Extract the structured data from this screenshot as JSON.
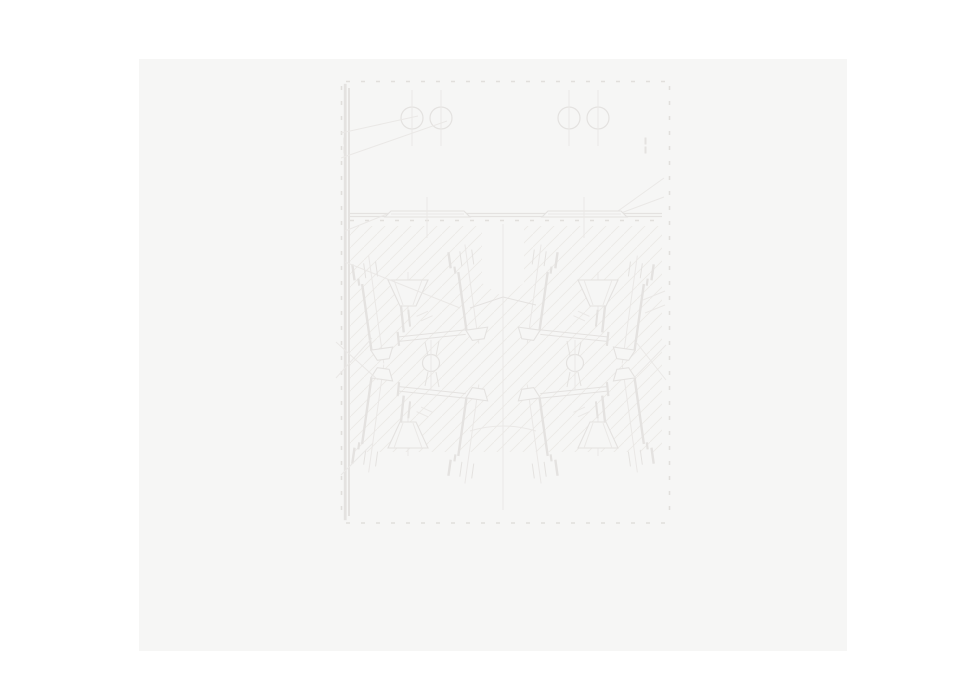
{
  "palette": {
    "page_background": "#ffffff",
    "canvas_background": "#f6f6f5",
    "line": "#e4e2e0",
    "faint": "#eae8e6",
    "tick": "#e1dfdc",
    "hatch": "#eceae8",
    "bg": "#f6f6f5"
  },
  "canvas": {
    "x": 139,
    "y": 59,
    "width": 708,
    "height": 592
  },
  "drawing": {
    "type": "technical-section-drawing",
    "viewbox": "0 0 961 694",
    "hatch": {
      "size": 13
    },
    "frame": {
      "outer": [
        344.5,
        84.5,
        322,
        435
      ],
      "inner": [
        348.5,
        88.5,
        314,
        427
      ]
    },
    "under_shapes": [
      {
        "t": "rect",
        "x": 139,
        "y": 59,
        "w": 708,
        "h": 592,
        "f": "canvas_background",
        "s": "none",
        "name": "canvas-panel"
      },
      {
        "t": "rect",
        "x": 349,
        "y": 226,
        "w": 313,
        "h": 226,
        "f": "url(#hatch)",
        "s": "none",
        "name": "section-hatch-region"
      },
      {
        "t": "poly",
        "pts": "482,222 524,222 524,283 503,297 482,283",
        "f": "bg",
        "s": "none",
        "name": "center-clear-notch"
      }
    ],
    "assembly": {
      "groups": [
        {
          "name": "bolt-assembly-upper-left",
          "tr": ""
        },
        {
          "name": "bolt-assembly-upper-right",
          "tr": "translate(1006 0) scale(-1 1)"
        },
        {
          "name": "bolt-assembly-lower-left",
          "tr": "translate(0 728) scale(1 -1)"
        },
        {
          "name": "bolt-assembly-lower-right",
          "tr": "translate(1006 728) scale(-1 -1)"
        }
      ],
      "shapes": [
        {
          "t": "g",
          "tr": "rotate(-8 376 308)",
          "name": "outer-stud-bolt",
          "items": [
            {
              "t": "line",
              "x1": 376,
              "y1": 255,
              "x2": 376,
              "y2": 364,
              "s": "faint",
              "w": 1
            },
            {
              "t": "rect",
              "x": 358,
              "y": 262,
              "w": 1.2,
              "h": 15,
              "s": "line",
              "f": "bg"
            },
            {
              "t": "line",
              "x1": 370,
              "y1": 262,
              "x2": 370,
              "y2": 277,
              "s": "line",
              "w": 1
            },
            {
              "t": "line",
              "x1": 382,
              "y1": 262,
              "x2": 382,
              "y2": 277,
              "s": "line",
              "w": 1
            },
            {
              "t": "rect",
              "x": 362,
              "y": 277,
              "w": 1.1,
              "h": 6,
              "s": "line",
              "f": "bg"
            },
            {
              "t": "rect",
              "x": 365,
              "y": 283,
              "w": 1.2,
              "h": 66,
              "s": "line",
              "f": "bg"
            },
            {
              "t": "poly",
              "pts": "365,349 387,349 382,360 370,360",
              "s": "line",
              "f": "bg",
              "w": 1.1
            }
          ]
        },
        {
          "t": "g",
          "tr": "rotate(-8 472 295)",
          "name": "inner-stud-bolt",
          "items": [
            {
              "t": "line",
              "x1": 472,
              "y1": 244,
              "x2": 472,
              "y2": 344,
              "s": "faint",
              "w": 1
            },
            {
              "t": "rect",
              "x": 454,
              "y": 250,
              "w": 1.2,
              "h": 15,
              "s": "line",
              "f": "bg"
            },
            {
              "t": "line",
              "x1": 466,
              "y1": 250,
              "x2": 466,
              "y2": 265,
              "s": "line",
              "w": 1
            },
            {
              "t": "line",
              "x1": 478,
              "y1": 250,
              "x2": 478,
              "y2": 265,
              "s": "line",
              "w": 1
            },
            {
              "t": "rect",
              "x": 458,
              "y": 265,
              "w": 1.1,
              "h": 6,
              "s": "line",
              "f": "bg"
            },
            {
              "t": "rect",
              "x": 461,
              "y": 271,
              "w": 1.2,
              "h": 58,
              "s": "line",
              "f": "bg"
            },
            {
              "t": "poly",
              "pts": "461,329 483,329 478,340 466,340",
              "s": "line",
              "f": "bg",
              "w": 1.1
            }
          ]
        },
        {
          "t": "g",
          "tr": "",
          "name": "countersink-funnel",
          "items": [
            {
              "t": "line",
              "x1": 408,
              "y1": 272,
              "x2": 408,
              "y2": 314,
              "s": "faint",
              "w": 1
            },
            {
              "t": "poly",
              "pts": "388,280 428,280 416,306 400,306",
              "s": "line",
              "f": "bg",
              "w": 1.1
            },
            {
              "t": "line",
              "x1": 394,
              "y1": 280,
              "x2": 403,
              "y2": 305,
              "s": "faint",
              "w": 1
            },
            {
              "t": "line",
              "x1": 422,
              "y1": 280,
              "x2": 413,
              "y2": 305,
              "s": "faint",
              "w": 1
            }
          ]
        },
        {
          "t": "g",
          "tr": "rotate(-6 430 320)",
          "name": "gate-block",
          "items": [
            {
              "t": "rect",
              "x": 402,
              "y": 303,
              "w": 1.2,
              "h": 26,
              "s": "line",
              "f": "bg"
            },
            {
              "t": "rect",
              "x": 409,
              "y": 308,
              "w": 1,
              "h": 16,
              "s": "line",
              "f": "bg"
            },
            {
              "t": "line",
              "x1": 417,
              "y1": 315,
              "x2": 429,
              "y2": 311,
              "s": "faint",
              "w": 1
            },
            {
              "t": "line",
              "x1": 421,
              "y1": 320,
              "x2": 433,
              "y2": 316,
              "s": "faint",
              "w": 1
            },
            {
              "t": "rect",
              "x": 396,
              "y": 329,
              "w": 1.1,
              "h": 13,
              "s": "line",
              "f": "bg"
            },
            {
              "t": "line",
              "x1": 396,
              "y1": 333.5,
              "x2": 464,
              "y2": 333.5,
              "s": "line",
              "w": 1
            },
            {
              "t": "line",
              "x1": 396,
              "y1": 338,
              "x2": 464,
              "y2": 338,
              "s": "line",
              "w": 1
            }
          ]
        },
        {
          "t": "g",
          "tr": "",
          "name": "valve-stem-lines",
          "items": [
            {
              "t": "line",
              "x1": 425,
              "y1": 342,
              "x2": 428,
              "y2": 356,
              "s": "line",
              "w": 1
            },
            {
              "t": "line",
              "x1": 439,
              "y1": 341,
              "x2": 436,
              "y2": 356,
              "s": "line",
              "w": 1
            }
          ]
        }
      ]
    },
    "over_shapes": [
      {
        "t": "rect",
        "x": 344.5,
        "y": 84.5,
        "w": 1.4,
        "h": 435,
        "s": "line",
        "f": "none",
        "name": "frame-outer-border"
      },
      {
        "t": "rect",
        "x": 348.5,
        "y": 88.5,
        "w": 1,
        "h": 427,
        "s": "line",
        "f": "none",
        "name": "frame-inner-border"
      },
      {
        "t": "line",
        "x1": 346,
        "y1": 81.5,
        "x2": 666,
        "y2": 81.5,
        "s": "tick",
        "w": 1.6,
        "dash": "4 11",
        "name": "frame-ticks-top"
      },
      {
        "t": "line",
        "x1": 346,
        "y1": 523,
        "x2": 666,
        "y2": 523,
        "s": "tick",
        "w": 1.6,
        "dash": "4 11",
        "name": "frame-ticks-bottom"
      },
      {
        "t": "line",
        "x1": 341.5,
        "y1": 86,
        "x2": 341.5,
        "y2": 519,
        "s": "tick",
        "w": 1.6,
        "dash": "4 11",
        "name": "frame-ticks-left"
      },
      {
        "t": "line",
        "x1": 669.5,
        "y1": 86,
        "x2": 669.5,
        "y2": 519,
        "s": "tick",
        "w": 1.6,
        "dash": "4 11",
        "name": "frame-ticks-right"
      },
      {
        "t": "rect",
        "x": 344,
        "y": 138,
        "w": 1,
        "h": 6,
        "s": "line",
        "f": "bg",
        "name": "wall-tab-left-upper"
      },
      {
        "t": "rect",
        "x": 344,
        "y": 147,
        "w": 1,
        "h": 6,
        "s": "line",
        "f": "bg",
        "name": "wall-tab-left-lower"
      },
      {
        "t": "rect",
        "x": 645,
        "y": 138,
        "w": 1,
        "h": 6,
        "s": "line",
        "f": "bg",
        "name": "wall-tab-right-upper"
      },
      {
        "t": "rect",
        "x": 645,
        "y": 147,
        "w": 1,
        "h": 6,
        "s": "line",
        "f": "bg",
        "name": "wall-tab-right-lower"
      },
      {
        "t": "line",
        "x1": 348,
        "y1": 213.5,
        "x2": 662,
        "y2": 213.5,
        "s": "line",
        "w": 1.2,
        "name": "divider-plate-top"
      },
      {
        "t": "line",
        "x1": 348,
        "y1": 216.5,
        "x2": 662,
        "y2": 216.5,
        "s": "line",
        "w": 1.2,
        "name": "divider-plate-bottom"
      },
      {
        "t": "line",
        "x1": 350,
        "y1": 220.5,
        "x2": 662,
        "y2": 220.5,
        "s": "tick",
        "w": 1.4,
        "dash": "4 11",
        "name": "divider-ticks"
      },
      {
        "t": "circle",
        "cx": 412,
        "cy": 118,
        "r": 11,
        "s": "line",
        "f": "none",
        "w": 1.2,
        "name": "top-hole-1"
      },
      {
        "t": "circle",
        "cx": 441,
        "cy": 118,
        "r": 11,
        "s": "line",
        "f": "none",
        "w": 1.2,
        "name": "top-hole-2"
      },
      {
        "t": "circle",
        "cx": 569,
        "cy": 118,
        "r": 11,
        "s": "line",
        "f": "none",
        "w": 1.2,
        "name": "top-hole-3"
      },
      {
        "t": "circle",
        "cx": 598,
        "cy": 118,
        "r": 11,
        "s": "line",
        "f": "none",
        "w": 1.2,
        "name": "top-hole-4"
      },
      {
        "t": "line",
        "x1": 412,
        "y1": 90,
        "x2": 412,
        "y2": 146,
        "s": "faint",
        "w": 1,
        "name": "hole-centerline-1"
      },
      {
        "t": "line",
        "x1": 441,
        "y1": 90,
        "x2": 441,
        "y2": 146,
        "s": "faint",
        "w": 1,
        "name": "hole-centerline-2"
      },
      {
        "t": "line",
        "x1": 569,
        "y1": 90,
        "x2": 569,
        "y2": 146,
        "s": "faint",
        "w": 1,
        "name": "hole-centerline-3"
      },
      {
        "t": "line",
        "x1": 598,
        "y1": 90,
        "x2": 598,
        "y2": 146,
        "s": "faint",
        "w": 1,
        "name": "hole-centerline-4"
      },
      {
        "t": "line",
        "x1": 341,
        "y1": 133,
        "x2": 418,
        "y2": 116,
        "s": "faint",
        "w": 1,
        "name": "leader-line"
      },
      {
        "t": "line",
        "x1": 341,
        "y1": 158,
        "x2": 447,
        "y2": 121,
        "s": "faint",
        "w": 1,
        "name": "leader-line"
      },
      {
        "t": "line",
        "x1": 345,
        "y1": 231,
        "x2": 392,
        "y2": 212,
        "s": "faint",
        "w": 1,
        "name": "leader-line"
      },
      {
        "t": "line",
        "x1": 618,
        "y1": 211,
        "x2": 664,
        "y2": 178,
        "s": "faint",
        "w": 1,
        "name": "leader-line"
      },
      {
        "t": "line",
        "x1": 621,
        "y1": 213,
        "x2": 664,
        "y2": 197,
        "s": "faint",
        "w": 1,
        "name": "leader-line"
      },
      {
        "t": "poly",
        "pts": "385,217 391,211 464,211 470,217",
        "s": "line",
        "f": "bg",
        "w": 1.1,
        "name": "seat-plate-left"
      },
      {
        "t": "line",
        "x1": 391,
        "y1": 214,
        "x2": 464,
        "y2": 214,
        "s": "faint",
        "w": 1,
        "name": "seat-plate-left-inner"
      },
      {
        "t": "line",
        "x1": 427,
        "y1": 197,
        "x2": 427,
        "y2": 238,
        "s": "faint",
        "w": 1,
        "name": "plate-centerline-left"
      },
      {
        "t": "poly",
        "pts": "542,217 548,211 621,211 627,217",
        "s": "line",
        "f": "bg",
        "w": 1.1,
        "name": "seat-plate-right"
      },
      {
        "t": "line",
        "x1": 548,
        "y1": 214,
        "x2": 621,
        "y2": 214,
        "s": "faint",
        "w": 1,
        "name": "seat-plate-right-inner"
      },
      {
        "t": "line",
        "x1": 584,
        "y1": 197,
        "x2": 584,
        "y2": 238,
        "s": "faint",
        "w": 1,
        "name": "plate-centerline-right"
      },
      {
        "t": "line",
        "x1": 503,
        "y1": 224,
        "x2": 503,
        "y2": 510,
        "s": "faint",
        "w": 1,
        "name": "vertical-centerline"
      },
      {
        "t": "line",
        "x1": 470,
        "y1": 308,
        "x2": 503,
        "y2": 297,
        "s": "line",
        "w": 1,
        "name": "center-peak-left"
      },
      {
        "t": "line",
        "x1": 503,
        "y1": 297,
        "x2": 536,
        "y2": 305,
        "s": "line",
        "w": 1,
        "name": "center-peak-right"
      },
      {
        "t": "path",
        "d": "M470,431 Q503,421 536,431",
        "s": "faint",
        "f": "none",
        "w": 1,
        "name": "center-dip-curve"
      },
      {
        "t": "circle",
        "cx": 431,
        "cy": 363,
        "r": 8.5,
        "s": "line",
        "f": "bg",
        "w": 1.2,
        "name": "ball-left"
      },
      {
        "t": "circle",
        "cx": 575,
        "cy": 363,
        "r": 8.5,
        "s": "line",
        "f": "bg",
        "w": 1.2,
        "name": "ball-right"
      },
      {
        "t": "line",
        "x1": 431,
        "y1": 340,
        "x2": 431,
        "y2": 390,
        "s": "faint",
        "w": 1,
        "name": "ball-centerline-left"
      },
      {
        "t": "line",
        "x1": 575,
        "y1": 340,
        "x2": 575,
        "y2": 390,
        "s": "faint",
        "w": 1,
        "name": "ball-centerline-right"
      },
      {
        "t": "line",
        "x1": 345,
        "y1": 262,
        "x2": 460,
        "y2": 308,
        "s": "faint",
        "w": 1,
        "name": "leader-line"
      },
      {
        "t": "line",
        "x1": 336,
        "y1": 342,
        "x2": 378,
        "y2": 380,
        "s": "faint",
        "w": 1,
        "name": "leader-line"
      },
      {
        "t": "line",
        "x1": 336,
        "y1": 378,
        "x2": 372,
        "y2": 338,
        "s": "faint",
        "w": 1,
        "name": "leader-line"
      },
      {
        "t": "line",
        "x1": 341,
        "y1": 475,
        "x2": 373,
        "y2": 443,
        "s": "faint",
        "w": 1,
        "name": "leader-line"
      },
      {
        "t": "line",
        "x1": 643,
        "y1": 300,
        "x2": 665,
        "y2": 291,
        "s": "faint",
        "w": 1,
        "name": "leader-line"
      },
      {
        "t": "line",
        "x1": 645,
        "y1": 313,
        "x2": 665,
        "y2": 305,
        "s": "faint",
        "w": 1,
        "name": "leader-line"
      },
      {
        "t": "line",
        "x1": 666,
        "y1": 345,
        "x2": 634,
        "y2": 378,
        "s": "faint",
        "w": 1,
        "name": "leader-line"
      },
      {
        "t": "line",
        "x1": 666,
        "y1": 380,
        "x2": 636,
        "y2": 342,
        "s": "faint",
        "w": 1,
        "name": "leader-line"
      }
    ]
  }
}
